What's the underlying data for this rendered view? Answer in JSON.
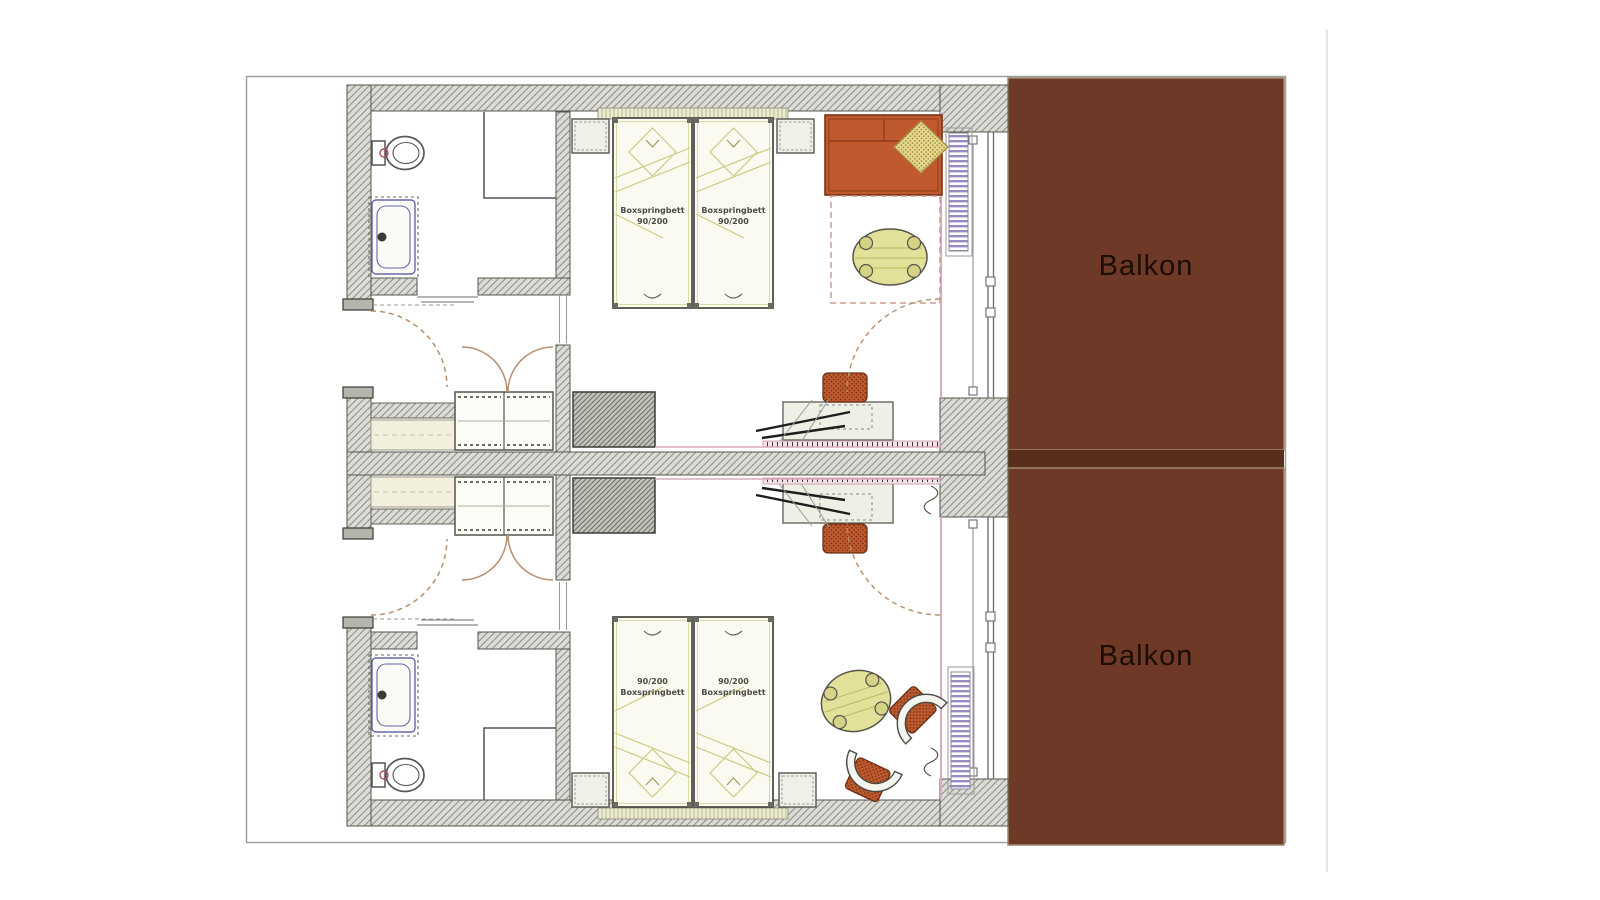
{
  "labels": {
    "balcony_top": "Balkon",
    "balcony_bottom": "Balkon"
  },
  "beds": {
    "top_left": {
      "line1": "Boxspringbett",
      "line2": "90/200"
    },
    "top_right": {
      "line1": "Boxspringbett",
      "line2": "90/200"
    },
    "bottom_left": {
      "line1": "90/200",
      "line2": "Boxspringbett"
    },
    "bottom_right": {
      "line1": "90/200",
      "line2": "Boxspringbett"
    }
  },
  "colors": {
    "balcony": "#6E3927",
    "balcony_divider": "#5A2E1D",
    "balcony_edge": "#9A8A68",
    "wall_fill": "#DCDCD6",
    "wall_hatch": "#8E8E86",
    "sofa": "#C05A2E",
    "pillow": "#E7D98E",
    "table": "#E3E09A",
    "chair_seat": "#BF5B30",
    "bed_fill": "#FBFAF0",
    "bed_lines": "#C8CC84",
    "radiator": "#9B8AC2",
    "finish_line_pink": "#DBA8BC",
    "door_arc": "#B98F6D",
    "tub_outline": "#6668A8"
  }
}
